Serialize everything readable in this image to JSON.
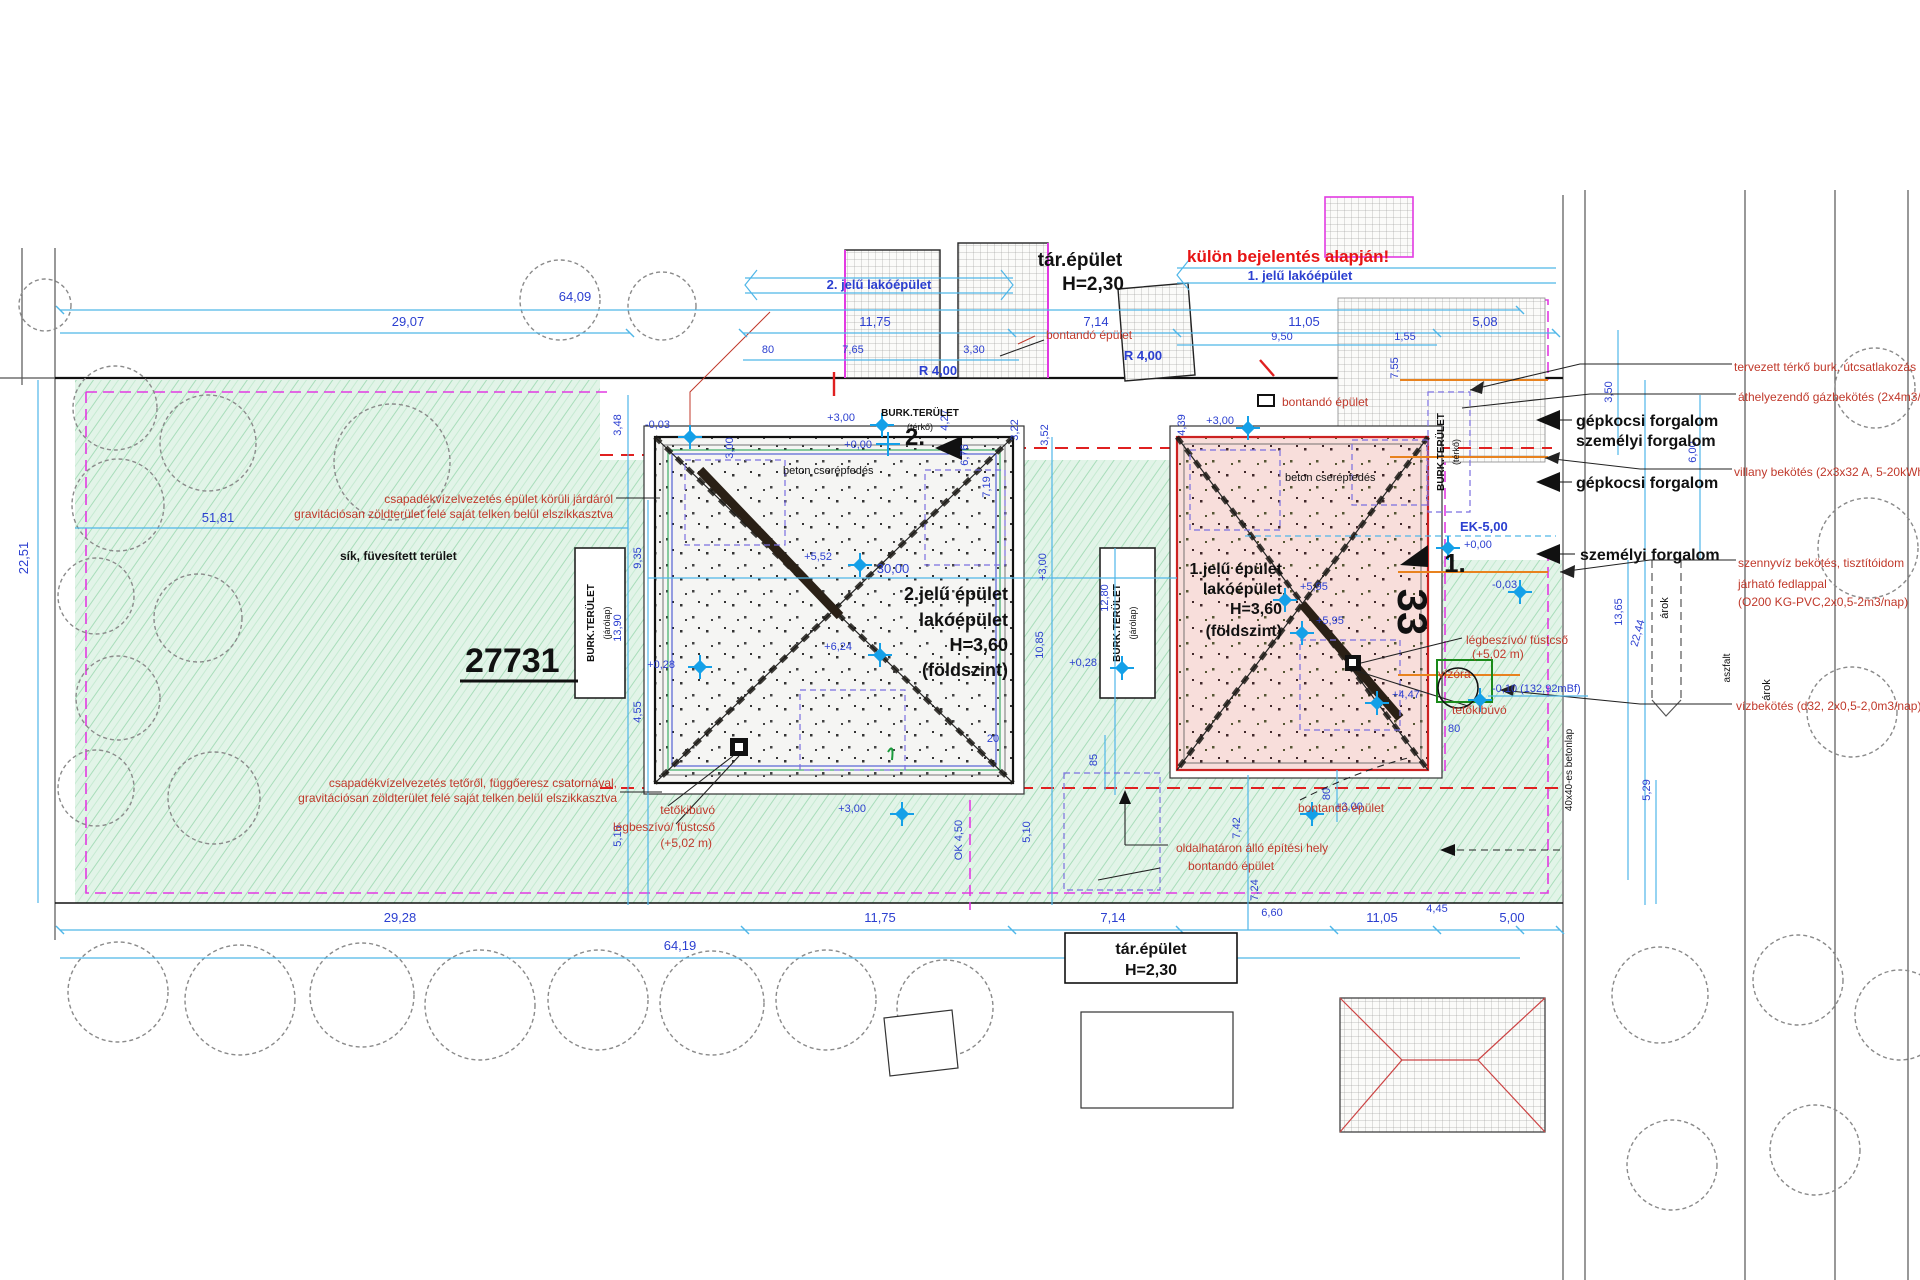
{
  "t": {
    "banner_b2": "2. jelű lakóépület",
    "banner_b1": "1. jelű lakóépület",
    "tar_top_1": "tár.épület",
    "tar_top_2": "H=2,30",
    "kulon": "külön bejelentés alapján!",
    "tar_bottom_1": "tár.épület",
    "tar_bottom_2": "H=2,30"
  },
  "d": {
    "top_total": "64,09",
    "t29_07": "29,07",
    "t11_75": "11,75",
    "t7_14": "7,14",
    "t11_05": "11,05",
    "t5_08": "5,08",
    "t80": "80",
    "t7_65": "7,65",
    "t3_30": "3,30",
    "t9_50": "9,50",
    "t1_55": "1,55",
    "r4a": "R 4,00",
    "r4b": "R 4,00",
    "v4_27": "4,27",
    "v6_76": "6,76",
    "v7_19": "7,19",
    "v3_22": "3,22",
    "v3_52": "3,52",
    "v4_39": "4,39",
    "v7_55": "7,55",
    "v3_00": "3,00",
    "l22_51": "22,51",
    "l51_81": "51,81",
    "l3_48": "3,48",
    "l9_35": "9,35",
    "l13_90": "13,90",
    "l4_55": "4,55",
    "l5_10": "5,10",
    "m0_03a": "-0,03",
    "p3_00a": "+3,00",
    "p3_00b": "+3,00",
    "p0_00a": "+0,00",
    "m30_00": "30,00",
    "m10_85": "10,85",
    "m12_80": "12,80",
    "p0_28a": "+0,28",
    "p0_28b": "+0,28",
    "m20": "20",
    "m85": "85",
    "ok450": "OK 4,50",
    "m5_10": "5,10",
    "m7_42": "7,42",
    "m7_24": "7,24",
    "m80": "80",
    "p3_00c": "+3,00",
    "p3_00d": "+3,00",
    "p3_00e": "+3,00",
    "p5_52": "+5,52",
    "p6_24": "+6,24",
    "p5_95a": "+5,95",
    "p5_95b": "+5,95",
    "p4_47": "+4,47",
    "ek": "EK-5,00",
    "p0_00b": "+0,00",
    "m0_03b": "-0,03",
    "m0_10": "-0,10 (132,92mBf)",
    "r80": "80",
    "r3_50": "3,50",
    "r6_00": "6,00",
    "r13_65": "13,65",
    "r22_44": "22,44",
    "r5_29": "5,29",
    "b29_28": "29,28",
    "b11_75": "11,75",
    "b64_19": "64,19",
    "b7_14": "7,14",
    "b6_60": "6,60",
    "b11_05": "11,05",
    "b4_45": "4,45",
    "b5_00": "5,00"
  },
  "b": {
    "b2_line1": "2.jelű épület",
    "b2_line2": "lakóépület",
    "b2_line3": "H=3,60",
    "b2_line4": "(földszint)",
    "b1_line1": "1.jelű épület",
    "b1_line2": "lakóépület",
    "b1_line3": "H=3,60",
    "b1_line4": "(földszint)",
    "b2_roof": "beton cserépfedés",
    "b1_roof": "beton cserépfedés",
    "b2_marker": "2.",
    "b1_marker": "1.",
    "b1_number": "33",
    "parcel_number": "27731",
    "burk_jarolap_1": "BURK.TERÜLET",
    "burk_jarolap_2": "(járólap)",
    "burk_jarolap_3": "BURK.TERÜLET",
    "burk_jarolap_4": "(járólap)",
    "burk_terko_top_1": "BURK.TERÜLET",
    "burk_terko_top_2": "(térkő)",
    "burk_terko_right_1": "BURK.TERÜLET",
    "burk_terko_right_2": "(térkő)"
  },
  "r": {
    "left1a": "csapadékvízelvezetés épület körüli járdáról",
    "left1b": "gravitációsan zöldterület felé saját telken belül elszikkasztva",
    "left2a": "csapadékvízelvezetés tetőről, függőeresz csatornával,",
    "left2b": "gravitációsan zöldterület felé saját telken belül elszikkasztva",
    "right1": "tervezett térkő burk. útcsatlakozás",
    "right2": "áthelyezendő gázbekötés (2x4m3/h)",
    "right3": "villany bekötés (2x3x32 A, 5-20kWh)",
    "right4a": "szennyvíz bekötés, tisztítóidom",
    "right4b": "járható fedlappal",
    "right4c": "(O200 KG-PVC,2x0,5-2m3/nap)",
    "right5": "vízbekötés (d32, 2x0,5-2,0m3/nap)",
    "bontando1": "bontandó épület",
    "bontando2": "bontandó épület",
    "bontando3": "bontandó épület",
    "bontando4": "bontandó épület",
    "oldalhataron": "oldalhatáron álló építési hely",
    "tetokibuvo_b2": "tetőkibúvó",
    "legbeszivo_b2a": "légbeszívó/ füstcső",
    "legbeszivo_b2b": "(+5,02 m)",
    "legbeszivo_b1a": "légbeszívó/ füstcső",
    "legbeszivo_b1b": "(+5,02 m)",
    "tetokibuvo_b1": "tetőkibúvó",
    "vizora": "vízóra"
  },
  "m": {
    "sik": "sík, füvesített terület",
    "gepkocsi1": "gépkocsi forgalom",
    "szemelyi1": "személyi forgalom",
    "gepkocsi2": "gépkocsi forgalom",
    "szemelyi2": "személyi forgalom",
    "arok1": "árok",
    "arok2": "árok",
    "aszfalt": "aszfalt",
    "betonlap": "40x40-es betonlap"
  },
  "colors": {
    "dim_blue": "#2b3fd0",
    "cyan_line": "#4fb6e8",
    "annotation_red": "#c0392b",
    "alert_red": "#e71414",
    "magenta_boundary": "#e23ae2",
    "green_area": "#e2f4e8",
    "building1_fill": "#f8dedb",
    "building2_fill": "#f5f5f3",
    "orange_utility": "#e8821e"
  }
}
